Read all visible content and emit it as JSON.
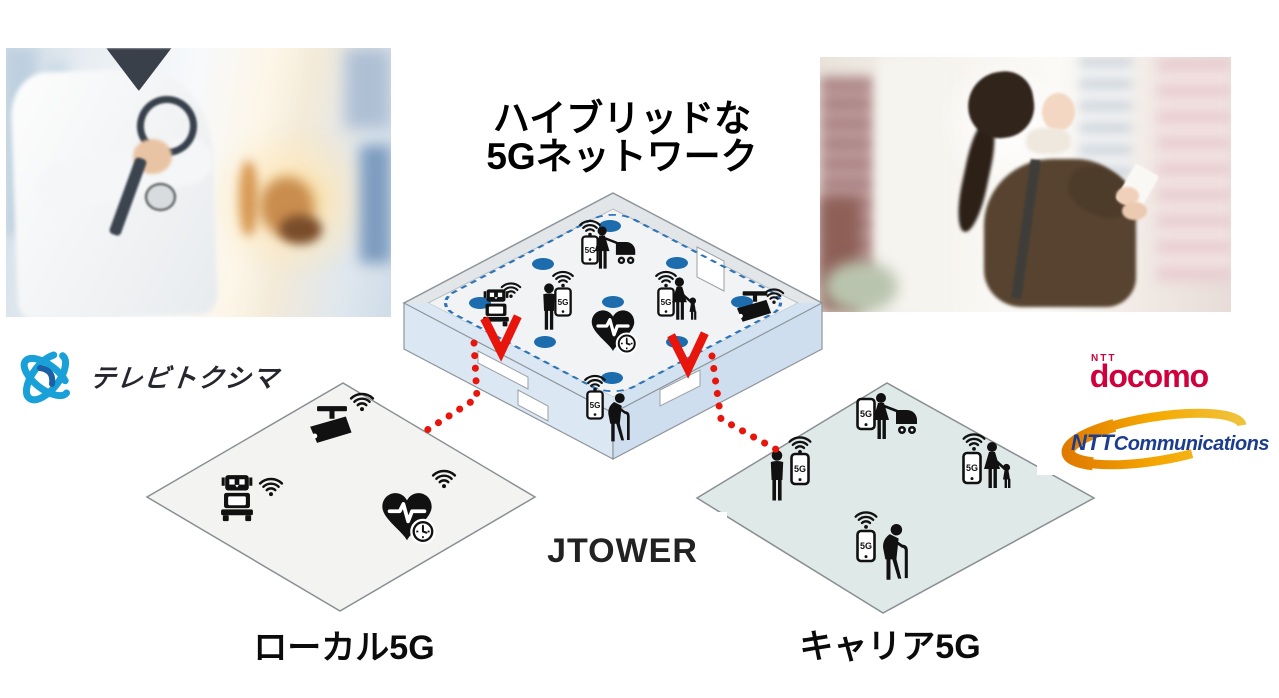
{
  "title": {
    "line1": "ハイブリッドな",
    "line2": "5Gネットワーク"
  },
  "center_label": "JTOWER",
  "zones": {
    "local": {
      "label": "ローカル5G",
      "fill": "#f3f3f1",
      "icons": [
        "cctv-camera",
        "robot",
        "heart-monitor"
      ]
    },
    "carrier": {
      "label": "キャリア5G",
      "fill": "#dfe9e7",
      "icons": [
        "woman-with-stroller",
        "man-with-phone",
        "woman-with-child",
        "elderly-man-with-cane"
      ]
    }
  },
  "device_label": "5G",
  "hybrid_floor": {
    "icons": [
      "woman-with-stroller",
      "man-with-phone",
      "robot",
      "heart-monitor",
      "woman-with-child",
      "cctv-camera",
      "elderly-man-with-cane"
    ],
    "antenna_dot_color": "#1c6cae",
    "coverage_loop_color": "#2d74b8",
    "connection_color": "#e8150c"
  },
  "logos": {
    "tv_tokushima": {
      "name": "テレビトクシマ",
      "brand_color": "#19a0d8",
      "accent_color": "#1b5fa6"
    },
    "docomo": {
      "prefix": "NTT",
      "name": "docomo",
      "brand_color": "#d0003c"
    },
    "ntt_communications": {
      "prefix": "NTT",
      "name": "Communications",
      "text_color": "#1c3d8f",
      "swoosh_color": "#f0a200"
    }
  },
  "photos": {
    "left": "doctor-with-stethoscope-in-hospital",
    "right": "woman-using-smartphone-in-city"
  }
}
